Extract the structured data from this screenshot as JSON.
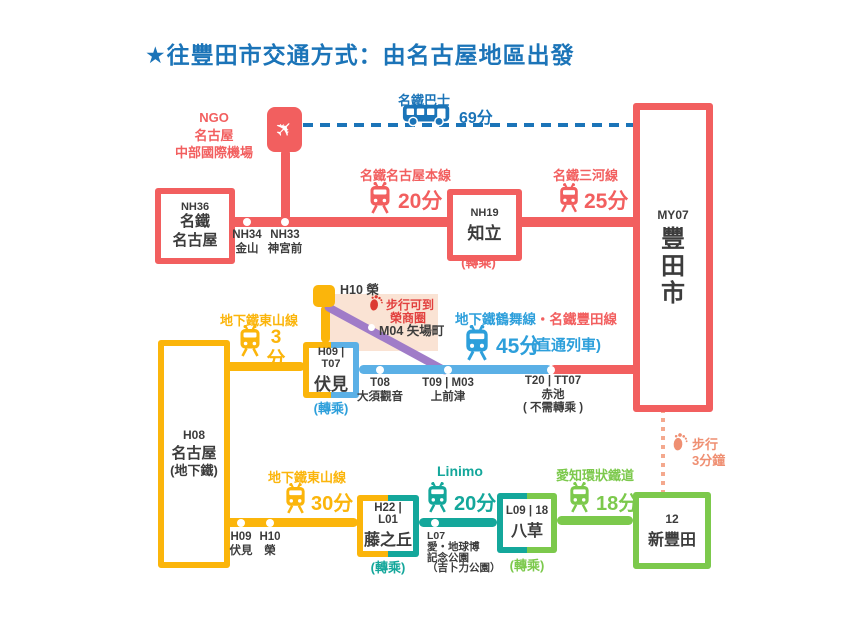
{
  "title": "★往豐田市交通方式：由名古屋地區出發",
  "colors": {
    "red": "#F25F5F",
    "deep_blue": "#1B74B8",
    "light_blue": "#2D9FDB",
    "rail_blue": "#5BB0E6",
    "yellow": "#FBB50B",
    "teal": "#14A79B",
    "green": "#7CC94C",
    "purple": "#A07CC8",
    "pink_bg": "#FAE3D4",
    "salmon": "#EF8F72",
    "walk_red": "#DC3A31",
    "text": "#3C3C3C"
  },
  "airport": {
    "code": "NGO",
    "name": "名古屋",
    "subname": "中部國際機場"
  },
  "bus": {
    "line": "名鐵巴士",
    "time": "69分"
  },
  "routes": {
    "honsen": {
      "name": "名鐵名古屋本線",
      "time": "20分"
    },
    "mikawa": {
      "name": "名鐵三河線",
      "time": "25分"
    },
    "higashiyama_top": {
      "name": "地下鐵東山線",
      "num": "3",
      "unit": "分"
    },
    "tsurumai": {
      "blue": "地下鐵鶴舞線",
      "sep": "・",
      "red": "名鐵豐田線",
      "time": "45分",
      "note": "(直通列車)"
    },
    "higashiyama": {
      "name": "地下鐵東山線",
      "time": "30分"
    },
    "linimo": {
      "name": "Linimo",
      "time": "20分"
    },
    "aikan": {
      "name": "愛知環狀鐵道",
      "time": "18分"
    },
    "walk_sakae": {
      "l1": "步行可到",
      "l2": "榮商圈"
    },
    "walk_shintoyota": {
      "l1": "步行",
      "l2": "3分鐘"
    }
  },
  "stations": {
    "nh36": {
      "code": "NH36",
      "l1": "名鐵",
      "l2": "名古屋"
    },
    "nh34": {
      "code": "NH34",
      "name": "金山"
    },
    "nh33": {
      "code": "NH33",
      "name": "神宮前"
    },
    "nh19": {
      "code": "NH19",
      "name": "知立",
      "transfer": "(轉乘)"
    },
    "my07": {
      "code": "MY07",
      "c1": "豐",
      "c2": "田",
      "c3": "市"
    },
    "h10_sakae": {
      "label": "H10 榮"
    },
    "m04": {
      "label": "M04 矢場町"
    },
    "fushimi": {
      "code": "H09 | T07",
      "name": "伏見",
      "transfer": "(轉乘)"
    },
    "t08": {
      "code": "T08",
      "name": "大須觀音"
    },
    "t09": {
      "code": "T09 | M03",
      "name": "上前津"
    },
    "t20": {
      "code": "T20 | TT07",
      "name": "赤池",
      "note": "( 不需轉乘 )"
    },
    "h08": {
      "code": "H08",
      "l1": "名古屋",
      "l2": "(地下鐵)"
    },
    "h09": {
      "code": "H09",
      "name": "伏見"
    },
    "h10": {
      "code": "H10",
      "name": "榮"
    },
    "fujigaoka": {
      "code": "H22 | L01",
      "name": "藤之丘",
      "transfer": "(轉乘)"
    },
    "l07": {
      "code": "L07",
      "l1": "愛・地球博",
      "l2": "記念公園",
      "l3": "（吉卜力公園）"
    },
    "yakusa": {
      "code": "L09 | 18",
      "name": "八草",
      "transfer": "(轉乘)"
    },
    "shintoyota": {
      "code": "12",
      "name": "新豐田"
    }
  }
}
